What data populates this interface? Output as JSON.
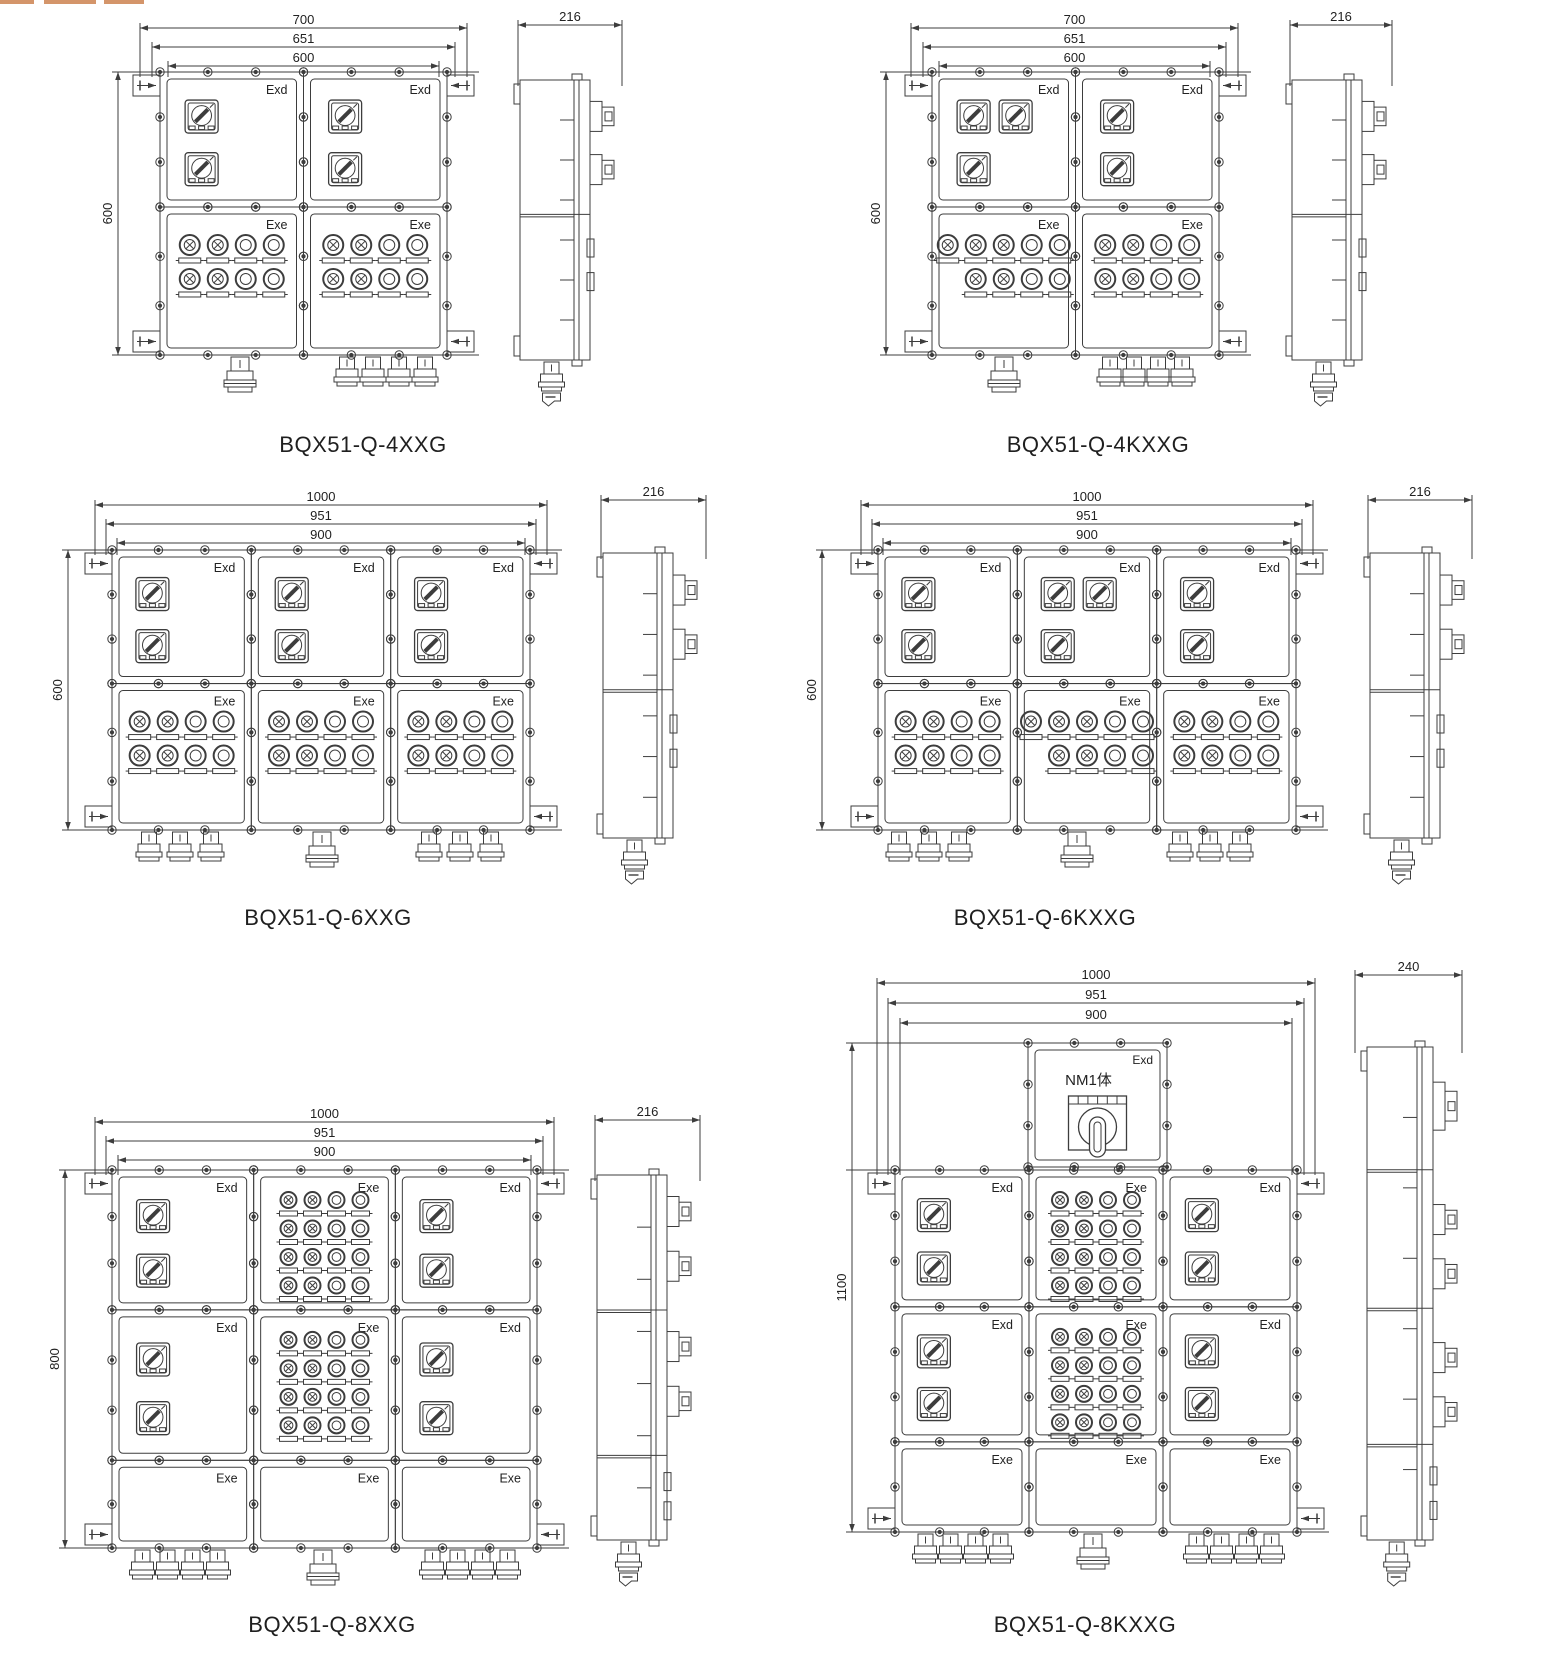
{
  "sheet": {
    "width": 1553,
    "height": 1662,
    "background": "#ffffff",
    "line_color": "#3d3d3d",
    "text_color": "#222222",
    "artifact_color": "#d4956a"
  },
  "labels": {
    "exd": "Exd",
    "exe": "Exe",
    "main_switch": "NM1体"
  },
  "diagrams": [
    {
      "name": "BQX51-Q-4XXG",
      "caption": {
        "x": 363,
        "y": 432
      },
      "front": {
        "x": 160,
        "y": 72,
        "w": 287,
        "h": 283,
        "rows": [
          0,
          0.477,
          1
        ],
        "cols": [
          0,
          0.5,
          1
        ],
        "cells": [
          {
            "r": 0,
            "c": 0,
            "t": "sw",
            "lab": "exd",
            "sw": [
              1,
              1
            ]
          },
          {
            "r": 0,
            "c": 1,
            "t": "sw",
            "lab": "exd",
            "sw": [
              1,
              1
            ]
          },
          {
            "r": 1,
            "c": 0,
            "t": "li",
            "lab": "exe",
            "li": [
              [
                "xxoo",
                0
              ],
              [
                "xxoo",
                0
              ]
            ]
          },
          {
            "r": 1,
            "c": 1,
            "t": "li",
            "lab": "exe",
            "li": [
              [
                "xxoo",
                0
              ],
              [
                "xxoo",
                0
              ]
            ]
          }
        ],
        "dims": [
          [
            "700",
            140,
            467,
            28
          ],
          [
            "651",
            152,
            455,
            47
          ],
          [
            "600",
            168,
            439,
            66
          ]
        ],
        "vdim": [
          "600",
          118
        ],
        "glands": [
          [
            240,
            1,
            1,
            25
          ],
          [
            386,
            4,
            0,
            26
          ]
        ]
      },
      "side": {
        "x": 520,
        "y": 80,
        "w": 70,
        "h": 280,
        "dim": [
          "216",
          518,
          622,
          25
        ],
        "divs": [
          0.48
        ],
        "handles": [
          0.13,
          0.32
        ],
        "latches": [
          0.6,
          0.72
        ],
        "big": -1
      }
    },
    {
      "name": "BQX51-Q-4KXXG",
      "caption": {
        "x": 1098,
        "y": 432
      },
      "front": {
        "x": 932,
        "y": 72,
        "w": 287,
        "h": 283,
        "rows": [
          0,
          0.477,
          1
        ],
        "cols": [
          0,
          0.5,
          1
        ],
        "cells": [
          {
            "r": 0,
            "c": 0,
            "t": "sw",
            "lab": "exd",
            "sw": [
              2,
              1
            ]
          },
          {
            "r": 0,
            "c": 1,
            "t": "sw",
            "lab": "exd",
            "sw": [
              1,
              1
            ]
          },
          {
            "r": 1,
            "c": 0,
            "t": "li",
            "lab": "exe",
            "li": [
              [
                "xxxoo",
                0
              ],
              [
                "xxoo",
                1
              ]
            ]
          },
          {
            "r": 1,
            "c": 1,
            "t": "li",
            "lab": "exe",
            "li": [
              [
                "xxoo",
                0
              ],
              [
                "xxoo",
                0
              ]
            ]
          }
        ],
        "dims": [
          [
            "700",
            911,
            1238,
            28
          ],
          [
            "651",
            923,
            1226,
            47
          ],
          [
            "600",
            939,
            1210,
            66
          ]
        ],
        "vdim": [
          "600",
          886
        ],
        "glands": [
          [
            1004,
            1,
            1,
            24
          ],
          [
            1146,
            4,
            0,
            24
          ]
        ]
      },
      "side": {
        "x": 1292,
        "y": 80,
        "w": 70,
        "h": 280,
        "dim": [
          "216",
          1290,
          1392,
          25
        ],
        "divs": [
          0.48
        ],
        "handles": [
          0.13,
          0.32
        ],
        "latches": [
          0.6,
          0.72
        ],
        "big": -1
      }
    },
    {
      "name": "BQX51-Q-6XXG",
      "caption": {
        "x": 328,
        "y": 905
      },
      "front": {
        "x": 112,
        "y": 550,
        "w": 418,
        "h": 280,
        "rows": [
          0,
          0.477,
          1
        ],
        "cols": [
          0,
          0.3333,
          0.6667,
          1
        ],
        "cells": [
          {
            "r": 0,
            "c": 0,
            "t": "sw",
            "lab": "exd",
            "sw": [
              1,
              1
            ]
          },
          {
            "r": 0,
            "c": 1,
            "t": "sw",
            "lab": "exd",
            "sw": [
              1,
              1
            ]
          },
          {
            "r": 0,
            "c": 2,
            "t": "sw",
            "lab": "exd",
            "sw": [
              1,
              1
            ]
          },
          {
            "r": 1,
            "c": 0,
            "t": "li",
            "lab": "exe",
            "li": [
              [
                "xxoo",
                0
              ],
              [
                "xxoo",
                0
              ]
            ]
          },
          {
            "r": 1,
            "c": 1,
            "t": "li",
            "lab": "exe",
            "li": [
              [
                "xxoo",
                0
              ],
              [
                "xxoo",
                0
              ]
            ]
          },
          {
            "r": 1,
            "c": 2,
            "t": "li",
            "lab": "exe",
            "li": [
              [
                "xxoo",
                0
              ],
              [
                "xxoo",
                0
              ]
            ]
          }
        ],
        "dims": [
          [
            "1000",
            95,
            547,
            505
          ],
          [
            "951",
            106,
            536,
            524
          ],
          [
            "900",
            117,
            525,
            543
          ]
        ],
        "vdim": [
          "600",
          68
        ],
        "glands": [
          [
            180,
            3,
            0,
            31
          ],
          [
            322,
            1,
            1,
            31
          ],
          [
            460,
            3,
            0,
            31
          ]
        ]
      },
      "side": {
        "x": 603,
        "y": 553,
        "w": 70,
        "h": 285,
        "dim": [
          "216",
          601,
          706,
          500
        ],
        "divs": [
          0.48
        ],
        "handles": [
          0.13,
          0.32
        ],
        "latches": [
          0.6,
          0.72
        ],
        "big": -1
      }
    },
    {
      "name": "BQX51-Q-6KXXG",
      "caption": {
        "x": 1045,
        "y": 905
      },
      "front": {
        "x": 878,
        "y": 550,
        "w": 418,
        "h": 280,
        "rows": [
          0,
          0.477,
          1
        ],
        "cols": [
          0,
          0.3333,
          0.6667,
          1
        ],
        "cells": [
          {
            "r": 0,
            "c": 0,
            "t": "sw",
            "lab": "exd",
            "sw": [
              1,
              1
            ]
          },
          {
            "r": 0,
            "c": 1,
            "t": "sw",
            "lab": "exd",
            "sw": [
              2,
              1
            ]
          },
          {
            "r": 0,
            "c": 2,
            "t": "sw",
            "lab": "exd",
            "sw": [
              1,
              1
            ]
          },
          {
            "r": 1,
            "c": 0,
            "t": "li",
            "lab": "exe",
            "li": [
              [
                "xxoo",
                0
              ],
              [
                "xxoo",
                0
              ]
            ]
          },
          {
            "r": 1,
            "c": 1,
            "t": "li",
            "lab": "exe",
            "li": [
              [
                "xxxoo",
                0
              ],
              [
                "xxoo",
                1
              ]
            ]
          },
          {
            "r": 1,
            "c": 2,
            "t": "li",
            "lab": "exe",
            "li": [
              [
                "xxoo",
                0
              ],
              [
                "xxoo",
                0
              ]
            ]
          }
        ],
        "dims": [
          [
            "1000",
            861,
            1313,
            505
          ],
          [
            "951",
            872,
            1302,
            524
          ],
          [
            "900",
            883,
            1291,
            543
          ]
        ],
        "vdim": [
          "600",
          822
        ],
        "glands": [
          [
            929,
            3,
            0,
            30
          ],
          [
            1077,
            1,
            1,
            30
          ],
          [
            1210,
            3,
            0,
            30
          ]
        ]
      },
      "side": {
        "x": 1370,
        "y": 553,
        "w": 70,
        "h": 285,
        "dim": [
          "216",
          1368,
          1472,
          500
        ],
        "divs": [
          0.48
        ],
        "handles": [
          0.13,
          0.32
        ],
        "latches": [
          0.6,
          0.72
        ],
        "big": -1
      }
    },
    {
      "name": "BQX51-Q-8XXG",
      "caption": {
        "x": 332,
        "y": 1612
      },
      "front": {
        "x": 112,
        "y": 1170,
        "w": 425,
        "h": 378,
        "rows": [
          0,
          0.37,
          0.768,
          1
        ],
        "cols": [
          0,
          0.3333,
          0.6667,
          1
        ],
        "cells": [
          {
            "r": 0,
            "c": 0,
            "t": "sw",
            "lab": "exd",
            "sw": [
              1,
              1
            ]
          },
          {
            "r": 0,
            "c": 1,
            "t": "li",
            "lab": "exe",
            "li": [
              [
                "xxoo",
                0
              ],
              [
                "xxoo",
                0
              ],
              [
                "xxoo",
                0
              ],
              [
                "xxoo",
                0
              ]
            ]
          },
          {
            "r": 0,
            "c": 2,
            "t": "sw",
            "lab": "exd",
            "sw": [
              1,
              1
            ]
          },
          {
            "r": 1,
            "c": 0,
            "t": "sw",
            "lab": "exd",
            "sw": [
              1,
              1
            ]
          },
          {
            "r": 1,
            "c": 1,
            "t": "li",
            "lab": "exe",
            "li": [
              [
                "xxoo",
                0
              ],
              [
                "xxoo",
                0
              ],
              [
                "xxoo",
                0
              ],
              [
                "xxoo",
                0
              ]
            ]
          },
          {
            "r": 1,
            "c": 2,
            "t": "sw",
            "lab": "exd",
            "sw": [
              1,
              1
            ]
          },
          {
            "r": 2,
            "c": 0,
            "t": "e",
            "lab": "exe"
          },
          {
            "r": 2,
            "c": 1,
            "t": "e",
            "lab": "exe"
          },
          {
            "r": 2,
            "c": 2,
            "t": "e",
            "lab": "exe"
          }
        ],
        "dims": [
          [
            "1000",
            95,
            554,
            1122
          ],
          [
            "951",
            106,
            543,
            1141
          ],
          [
            "900",
            118,
            531,
            1160
          ]
        ],
        "vdim": [
          "800",
          65
        ],
        "glands": [
          [
            180,
            4,
            0,
            25
          ],
          [
            323,
            1,
            1,
            25
          ],
          [
            470,
            4,
            0,
            25
          ]
        ]
      },
      "side": {
        "x": 597,
        "y": 1175,
        "w": 70,
        "h": 365,
        "dim": [
          "216",
          595,
          700,
          1120
        ],
        "divs": [
          0.37,
          0.768
        ],
        "handles": [
          0.1,
          0.25,
          0.47,
          0.62
        ],
        "latches": [
          0.84,
          0.92
        ],
        "big": -1
      }
    },
    {
      "name": "BQX51-Q-8KXXG",
      "caption": {
        "x": 1085,
        "y": 1612
      },
      "front": {
        "x": 895,
        "y": 1170,
        "w": 402,
        "h": 362,
        "rows": [
          0,
          0.378,
          0.751,
          1
        ],
        "cols": [
          0,
          0.3333,
          0.6667,
          1
        ],
        "top_unit": {
          "x": 1028,
          "y": 1043,
          "w": 139,
          "h": 124
        },
        "cells": [
          {
            "r": 0,
            "c": 0,
            "t": "sw",
            "lab": "exd",
            "sw": [
              1,
              1
            ]
          },
          {
            "r": 0,
            "c": 1,
            "t": "li",
            "lab": "exe",
            "li": [
              [
                "xxoo",
                0
              ],
              [
                "xxoo",
                0
              ],
              [
                "xxoo",
                0
              ],
              [
                "xxoo",
                0
              ]
            ]
          },
          {
            "r": 0,
            "c": 2,
            "t": "sw",
            "lab": "exd",
            "sw": [
              1,
              1
            ]
          },
          {
            "r": 1,
            "c": 0,
            "t": "sw",
            "lab": "exd",
            "sw": [
              1,
              1
            ]
          },
          {
            "r": 1,
            "c": 1,
            "t": "li",
            "lab": "exe",
            "li": [
              [
                "xxoo",
                0
              ],
              [
                "xxoo",
                0
              ],
              [
                "xxoo",
                0
              ],
              [
                "xxoo",
                0
              ]
            ]
          },
          {
            "r": 1,
            "c": 2,
            "t": "sw",
            "lab": "exd",
            "sw": [
              1,
              1
            ]
          },
          {
            "r": 2,
            "c": 0,
            "t": "e",
            "lab": "exe"
          },
          {
            "r": 2,
            "c": 1,
            "t": "e",
            "lab": "exe"
          },
          {
            "r": 2,
            "c": 2,
            "t": "e",
            "lab": "exe"
          }
        ],
        "dims": [
          [
            "1000",
            877,
            1315,
            983
          ],
          [
            "951",
            888,
            1304,
            1003
          ],
          [
            "900",
            900,
            1292,
            1023
          ]
        ],
        "vdim": [
          "1100",
          852,
          1043,
          1532
        ],
        "glands": [
          [
            963,
            4,
            0,
            25
          ],
          [
            1093,
            1,
            1,
            25
          ],
          [
            1234,
            4,
            0,
            25
          ]
        ]
      },
      "side": {
        "x": 1367,
        "y": 1047,
        "w": 66,
        "h": 493,
        "dim": [
          "240",
          1355,
          1462,
          975
        ],
        "divs": [
          0.249,
          0.53,
          0.806
        ],
        "handles": [
          0.35,
          0.46,
          0.63,
          0.74
        ],
        "latches": [
          0.87,
          0.94
        ],
        "big": 0.12
      }
    }
  ]
}
